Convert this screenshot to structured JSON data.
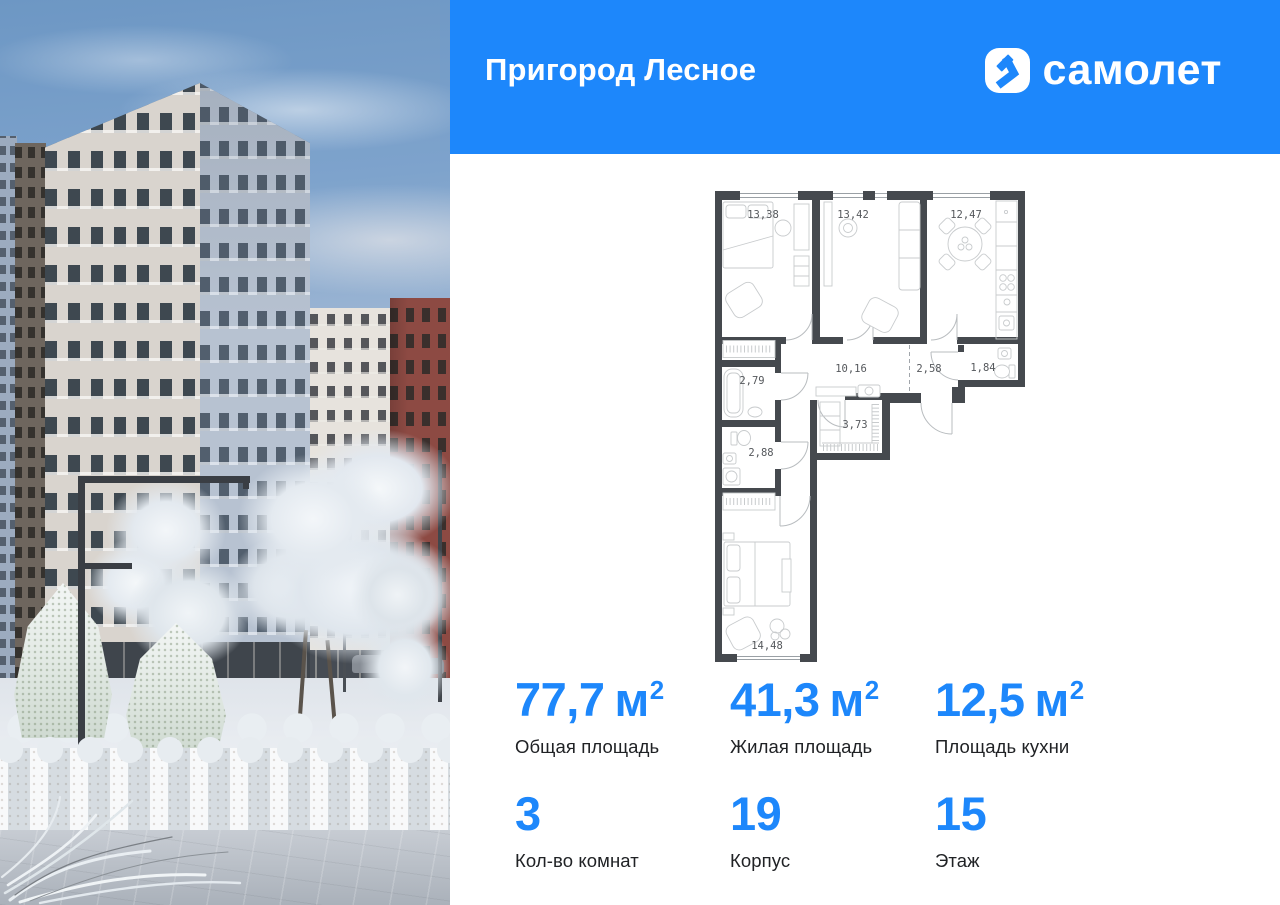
{
  "colors": {
    "accent": "#1d87fb",
    "plan_wall": "#45494e",
    "plan_label": "#55585c"
  },
  "header": {
    "project_title": "Пригород Лесное",
    "brand_name": "самолет"
  },
  "floorplan": {
    "rooms": [
      {
        "name": "bedroom-top",
        "area": "13,38"
      },
      {
        "name": "living-room",
        "area": "13,42"
      },
      {
        "name": "kitchen",
        "area": "12,47"
      },
      {
        "name": "bathroom",
        "area": "2,79"
      },
      {
        "name": "hallway",
        "area": "10,16"
      },
      {
        "name": "corridor",
        "area": "2,58"
      },
      {
        "name": "guest-wc",
        "area": "1,84"
      },
      {
        "name": "wc",
        "area": "2,88"
      },
      {
        "name": "wardrobe",
        "area": "3,73"
      },
      {
        "name": "bedroom-bottom",
        "area": "14,48"
      }
    ]
  },
  "stats": {
    "unit_base": "м",
    "unit_sup": "2",
    "row1": [
      {
        "value": "77,7",
        "label": "Общая площадь"
      },
      {
        "value": "41,3",
        "label": "Жилая площадь"
      },
      {
        "value": "12,5",
        "label": "Площадь кухни"
      }
    ],
    "row2": [
      {
        "value": "3",
        "label": "Кол-во комнат"
      },
      {
        "value": "19",
        "label": "Корпус"
      },
      {
        "value": "15",
        "label": "Этаж"
      }
    ]
  }
}
